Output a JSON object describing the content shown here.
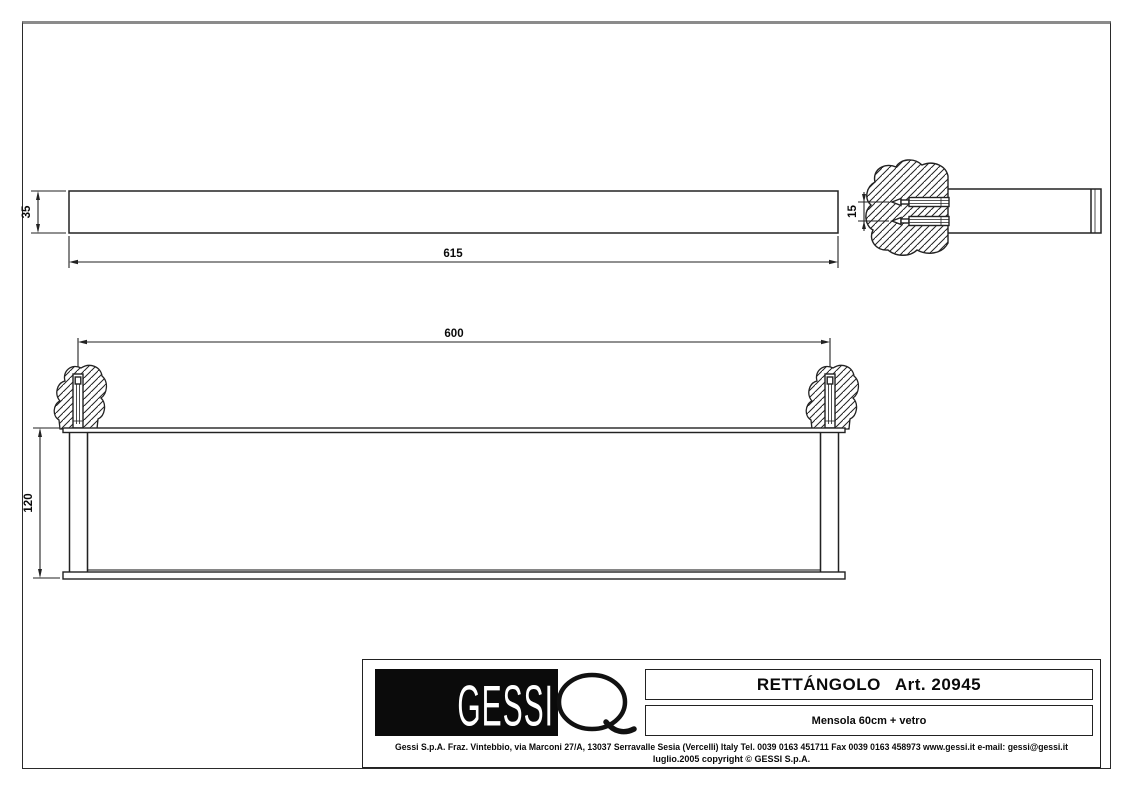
{
  "title_block": {
    "logo_text": "GESSI",
    "product_name": "RETTÁNGOLO",
    "article_number": "Art. 20945",
    "subtitle": "Mensola 60cm + vetro",
    "address_line": "Gessi S.p.A. Fraz. Vintebbio, via Marconi 27/A, 13037 Serravalle Sesia (Vercelli) Italy Tel. 0039 0163 451711 Fax 0039 0163 458973 www.gessi.it e-mail: gessi@gessi.it",
    "copyright_line": "luglio.2005 copyright © GESSI S.p.A."
  },
  "drawing": {
    "side_view": {
      "length_label": "615",
      "height_label": "35"
    },
    "anchor_detail": {
      "spacing_label": "15"
    },
    "front_view": {
      "width_label": "600",
      "height_label": "120"
    }
  },
  "colors": {
    "line": "#222222",
    "paper": "#ffffff",
    "logo_bg": "#0b0b0b"
  }
}
